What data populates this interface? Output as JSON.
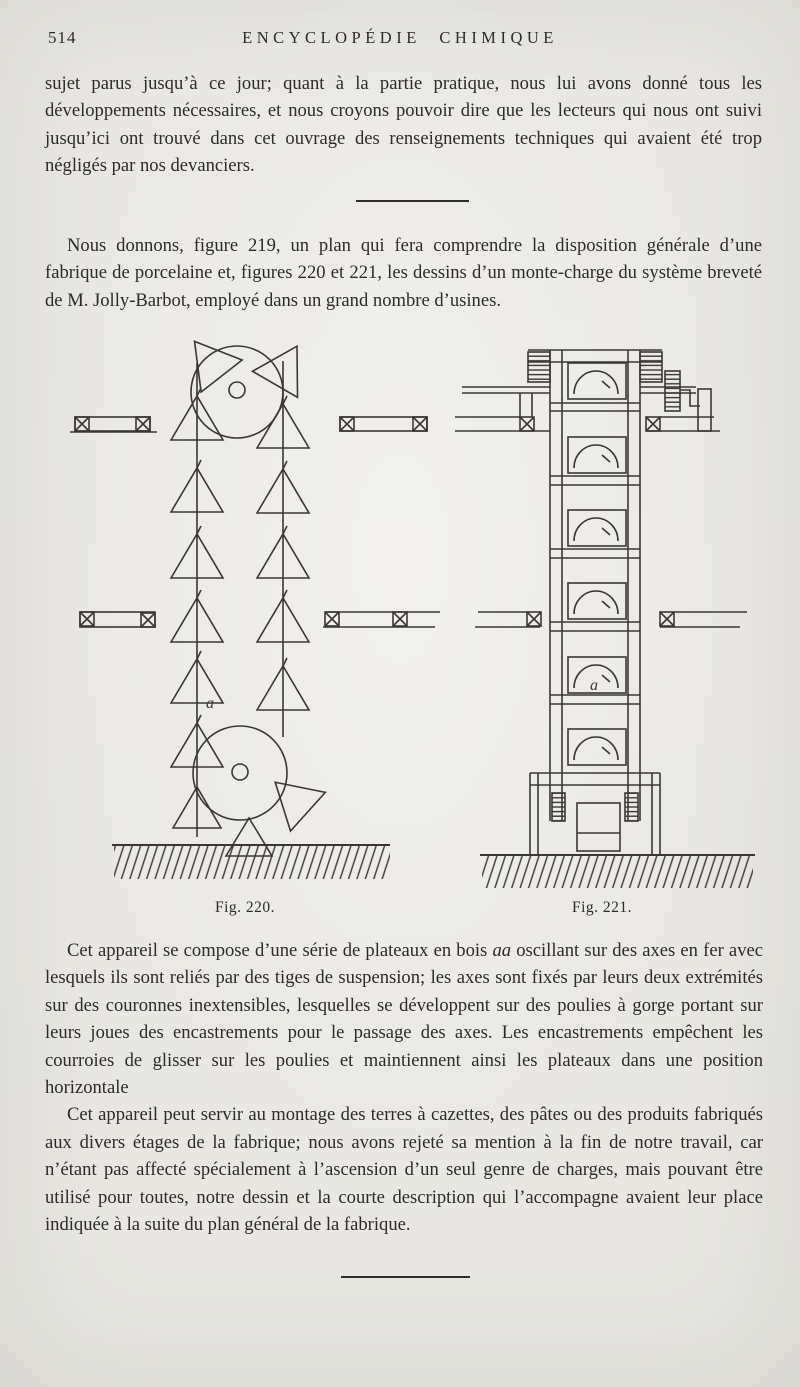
{
  "header": {
    "page_number": "514",
    "title": "ENCYCLOPÉDIE CHIMIQUE"
  },
  "body": {
    "p1": "sujet parus jusqu’à ce jour; quant à la partie pratique, nous lui avons donné tous les développements nécessaires, et nous croyons pouvoir dire que les lecteurs qui nous ont suivi jusqu’ici ont trouvé dans cet ouvrage des renseignements techniques qui avaient été trop négligés par nos devanciers.",
    "p2": "Nous donnons, figure 219, un plan qui fera comprendre la disposition générale d’une fabrique de porcelaine et, figures 220 et 221, les dessins d’un monte-charge du système breveté de M. Jolly-Barbot, employé dans un grand nombre d’usines.",
    "p3_before": "Cet appareil se compose d’une série de plateaux en bois ",
    "p3_italic": "aa",
    "p3_after": " oscillant sur des axes en fer avec lesquels ils sont reliés par des tiges de suspension; les axes sont fixés par leurs deux extrémités sur des couronnes inextensibles, lesquelles se développent sur des poulies à gorge portant sur leurs joues des encastrements pour le passage des axes. Les encastrements empêchent les courroies de glisser sur les poulies et maintiennent ainsi les plateaux dans une position horizontale",
    "p4": "Cet appareil peut servir au montage des terres à cazettes, des pâtes ou des produits fabriqués aux divers étages de la fabrique; nous avons rejeté sa mention à la fin de notre travail, car n’étant pas affecté spécialement à l’ascension d’un seul genre de charges, mais pouvant être utilisé pour toutes, notre dessin et la courte description qui l’accompagne avaient leur place indiquée à la suite du plan général de la fabrique."
  },
  "figures": {
    "left": {
      "caption": "Fig. 220.",
      "label_a": "a"
    },
    "right": {
      "caption": "Fig. 221.",
      "label_a": "a"
    }
  },
  "colors": {
    "paper": "#eae9e5",
    "ink": "#2d2b27",
    "figure_line": "#3b3833"
  }
}
